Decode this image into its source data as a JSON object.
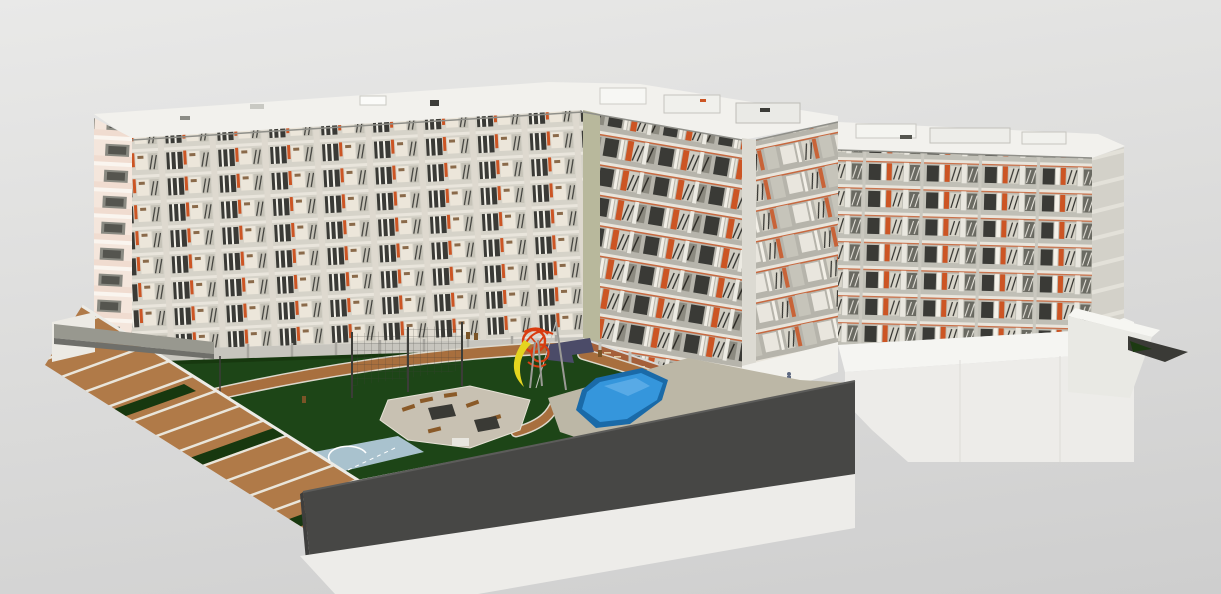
{
  "meta": {
    "description": "3D BIM model render of a residential apartment complex: three connected multi-storey blocks around a landscaped courtyard with swimming pool, playground tower with slide, sports court, seating plaza and terraced steps, viewed in aerial perspective on a plain gray viewport background.",
    "view": "aerial-perspective-3d",
    "visible_ui_chrome": "none"
  },
  "scene": {
    "labels": {
      "door_number": "0 7"
    },
    "buildings": {
      "left_block": {
        "floors_visible": 8,
        "facade_tone": "white-cream with orange accents",
        "end_wall": "pink balconies"
      },
      "center_block": {
        "floors_visible": 9,
        "facade_tone": "gray with orange accents and dark balcony rails"
      },
      "right_block": {
        "floors_visible": 8,
        "facade_tone": "light gray with orange accents"
      }
    },
    "colors": {
      "bg_top": "#e9e9e8",
      "bg_mid": "#dddddc",
      "bg_bottom": "#cecece",
      "roof": "#f2f1ed",
      "roof_edge": "#8f8f89",
      "facade_a": "#d6d3c9",
      "facade_b": "#b6b4ab",
      "facade_c": "#c0bfb6",
      "pink_end": "#f4e6dc",
      "slab": "#e9e5dc",
      "window_dark": "#3a3a36",
      "accent_orange": "#cc5524",
      "terracotta": "#a5603a",
      "lawn": "#1d4517",
      "hedge": "#17380f",
      "path_brown": "#a86f3e",
      "path_edge": "#ddd8cc",
      "plaza": "#c8c1b2",
      "deck": "#bcb7a6",
      "pool_rim": "#1a6aa8",
      "pool_water": "#3596dc",
      "mat_navy": "#4b4b68",
      "court_blue": "#a9c2ce",
      "court_red": "#8f4a3e",
      "slide_yellow": "#e5d51f",
      "play_red": "#d93c10",
      "steps_brown": "#b07a48",
      "step_nosing": "#e9e5da",
      "wall_dark": "#474745",
      "podium": "#edece9",
      "podium_bright": "#f5f5f2",
      "ramp_gray": "#98988f",
      "bin_brown": "#7a5427",
      "metal_gray": "#9a9a95",
      "lounger_brown": "#8a5a28",
      "shade_dark": "#3a3a35",
      "figure_blue": "#5d6880",
      "text_dark": "#2e2e2c",
      "column_gray": "#a8a6a0",
      "junction_olive": "#b8b89c",
      "service_ramp_dark": "#3a3a36",
      "bush_green": "#1c3a12"
    },
    "elements": [
      {
        "name": "left-apartment-block",
        "desc": "long white residential slab, courtyard facade with balconies"
      },
      {
        "name": "center-apartment-block",
        "desc": "corner residential tower, gray facade, orange accents"
      },
      {
        "name": "right-apartment-block",
        "desc": "long gray residential slab on white podium"
      },
      {
        "name": "rooftop-equipment",
        "desc": "white roof decks with mechanical boxes"
      },
      {
        "name": "courtyard-lawn",
        "desc": "dark green turf courtyard"
      },
      {
        "name": "walking-paths",
        "desc": "brown paths with light curbs"
      },
      {
        "name": "colonnade-hedge",
        "desc": "ground-floor colonnade with hedge strip"
      },
      {
        "name": "swimming-pool",
        "desc": "freeform blue pool with tan deck"
      },
      {
        "name": "playground-tower",
        "desc": "red lattice climbing tower"
      },
      {
        "name": "playground-slide",
        "desc": "yellow curved slide"
      },
      {
        "name": "rubber-mat",
        "desc": "navy L-shaped play surface"
      },
      {
        "name": "climbing-net",
        "desc": "dark net fence on poles"
      },
      {
        "name": "sports-court",
        "desc": "light blue half court with white arc"
      },
      {
        "name": "seating-plaza",
        "desc": "gravel plaza with sun loungers and shade tables"
      },
      {
        "name": "litter-bins",
        "desc": "small brown bins along paths"
      },
      {
        "name": "terraced-steps",
        "desc": "wide wooden terraces descending to street"
      },
      {
        "name": "access-ramp",
        "desc": "gray pedestrian ramp crossing the steps"
      },
      {
        "name": "perimeter-wall",
        "desc": "dark gray sectioned wall in foreground"
      },
      {
        "name": "podium-base",
        "desc": "white podium the complex sits on"
      },
      {
        "name": "service-ramp",
        "desc": "dark ramp wedge at far right"
      },
      {
        "name": "door-number",
        "desc": "unit number painted on lobby wall"
      },
      {
        "name": "scale-figure",
        "desc": "small human figure at lobby"
      }
    ]
  }
}
